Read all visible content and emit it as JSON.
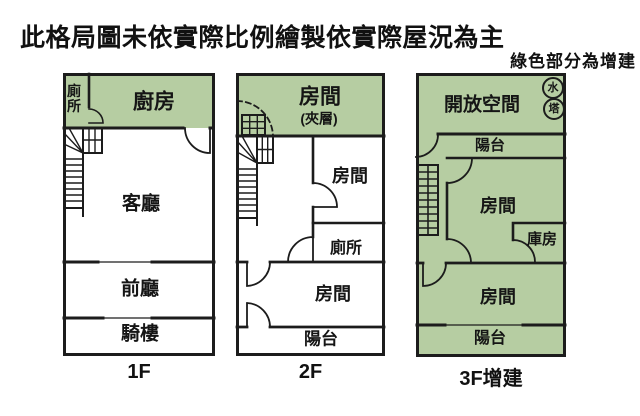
{
  "title": "此格局圖未依實際比例繪製依實際屋況為主",
  "legend_note": "綠色部分為增建",
  "colors": {
    "addition_green": "#b6cda2",
    "wall": "#1c1c1c",
    "text": "#111111",
    "background": "#ffffff"
  },
  "floors": [
    {
      "label": "1F",
      "rooms": {
        "toilet": "廁所",
        "kitchen": "廚房",
        "living_room": "客廳",
        "front_hall": "前廳",
        "arcade": "騎樓"
      }
    },
    {
      "label": "2F",
      "rooms": {
        "mezzanine_room": "房間",
        "mezzanine_note": "(夾層)",
        "room_right": "房間",
        "toilet": "廁所",
        "room_bottom": "房間",
        "balcony": "陽台"
      }
    },
    {
      "label": "3F增建",
      "rooms": {
        "open_space": "開放空間",
        "balcony_top": "陽台",
        "room_middle": "房間",
        "storage": "庫房",
        "room_bottom": "房間",
        "balcony_bottom": "陽台"
      },
      "water_tower": {
        "top": "水",
        "bottom": "塔"
      }
    }
  ]
}
